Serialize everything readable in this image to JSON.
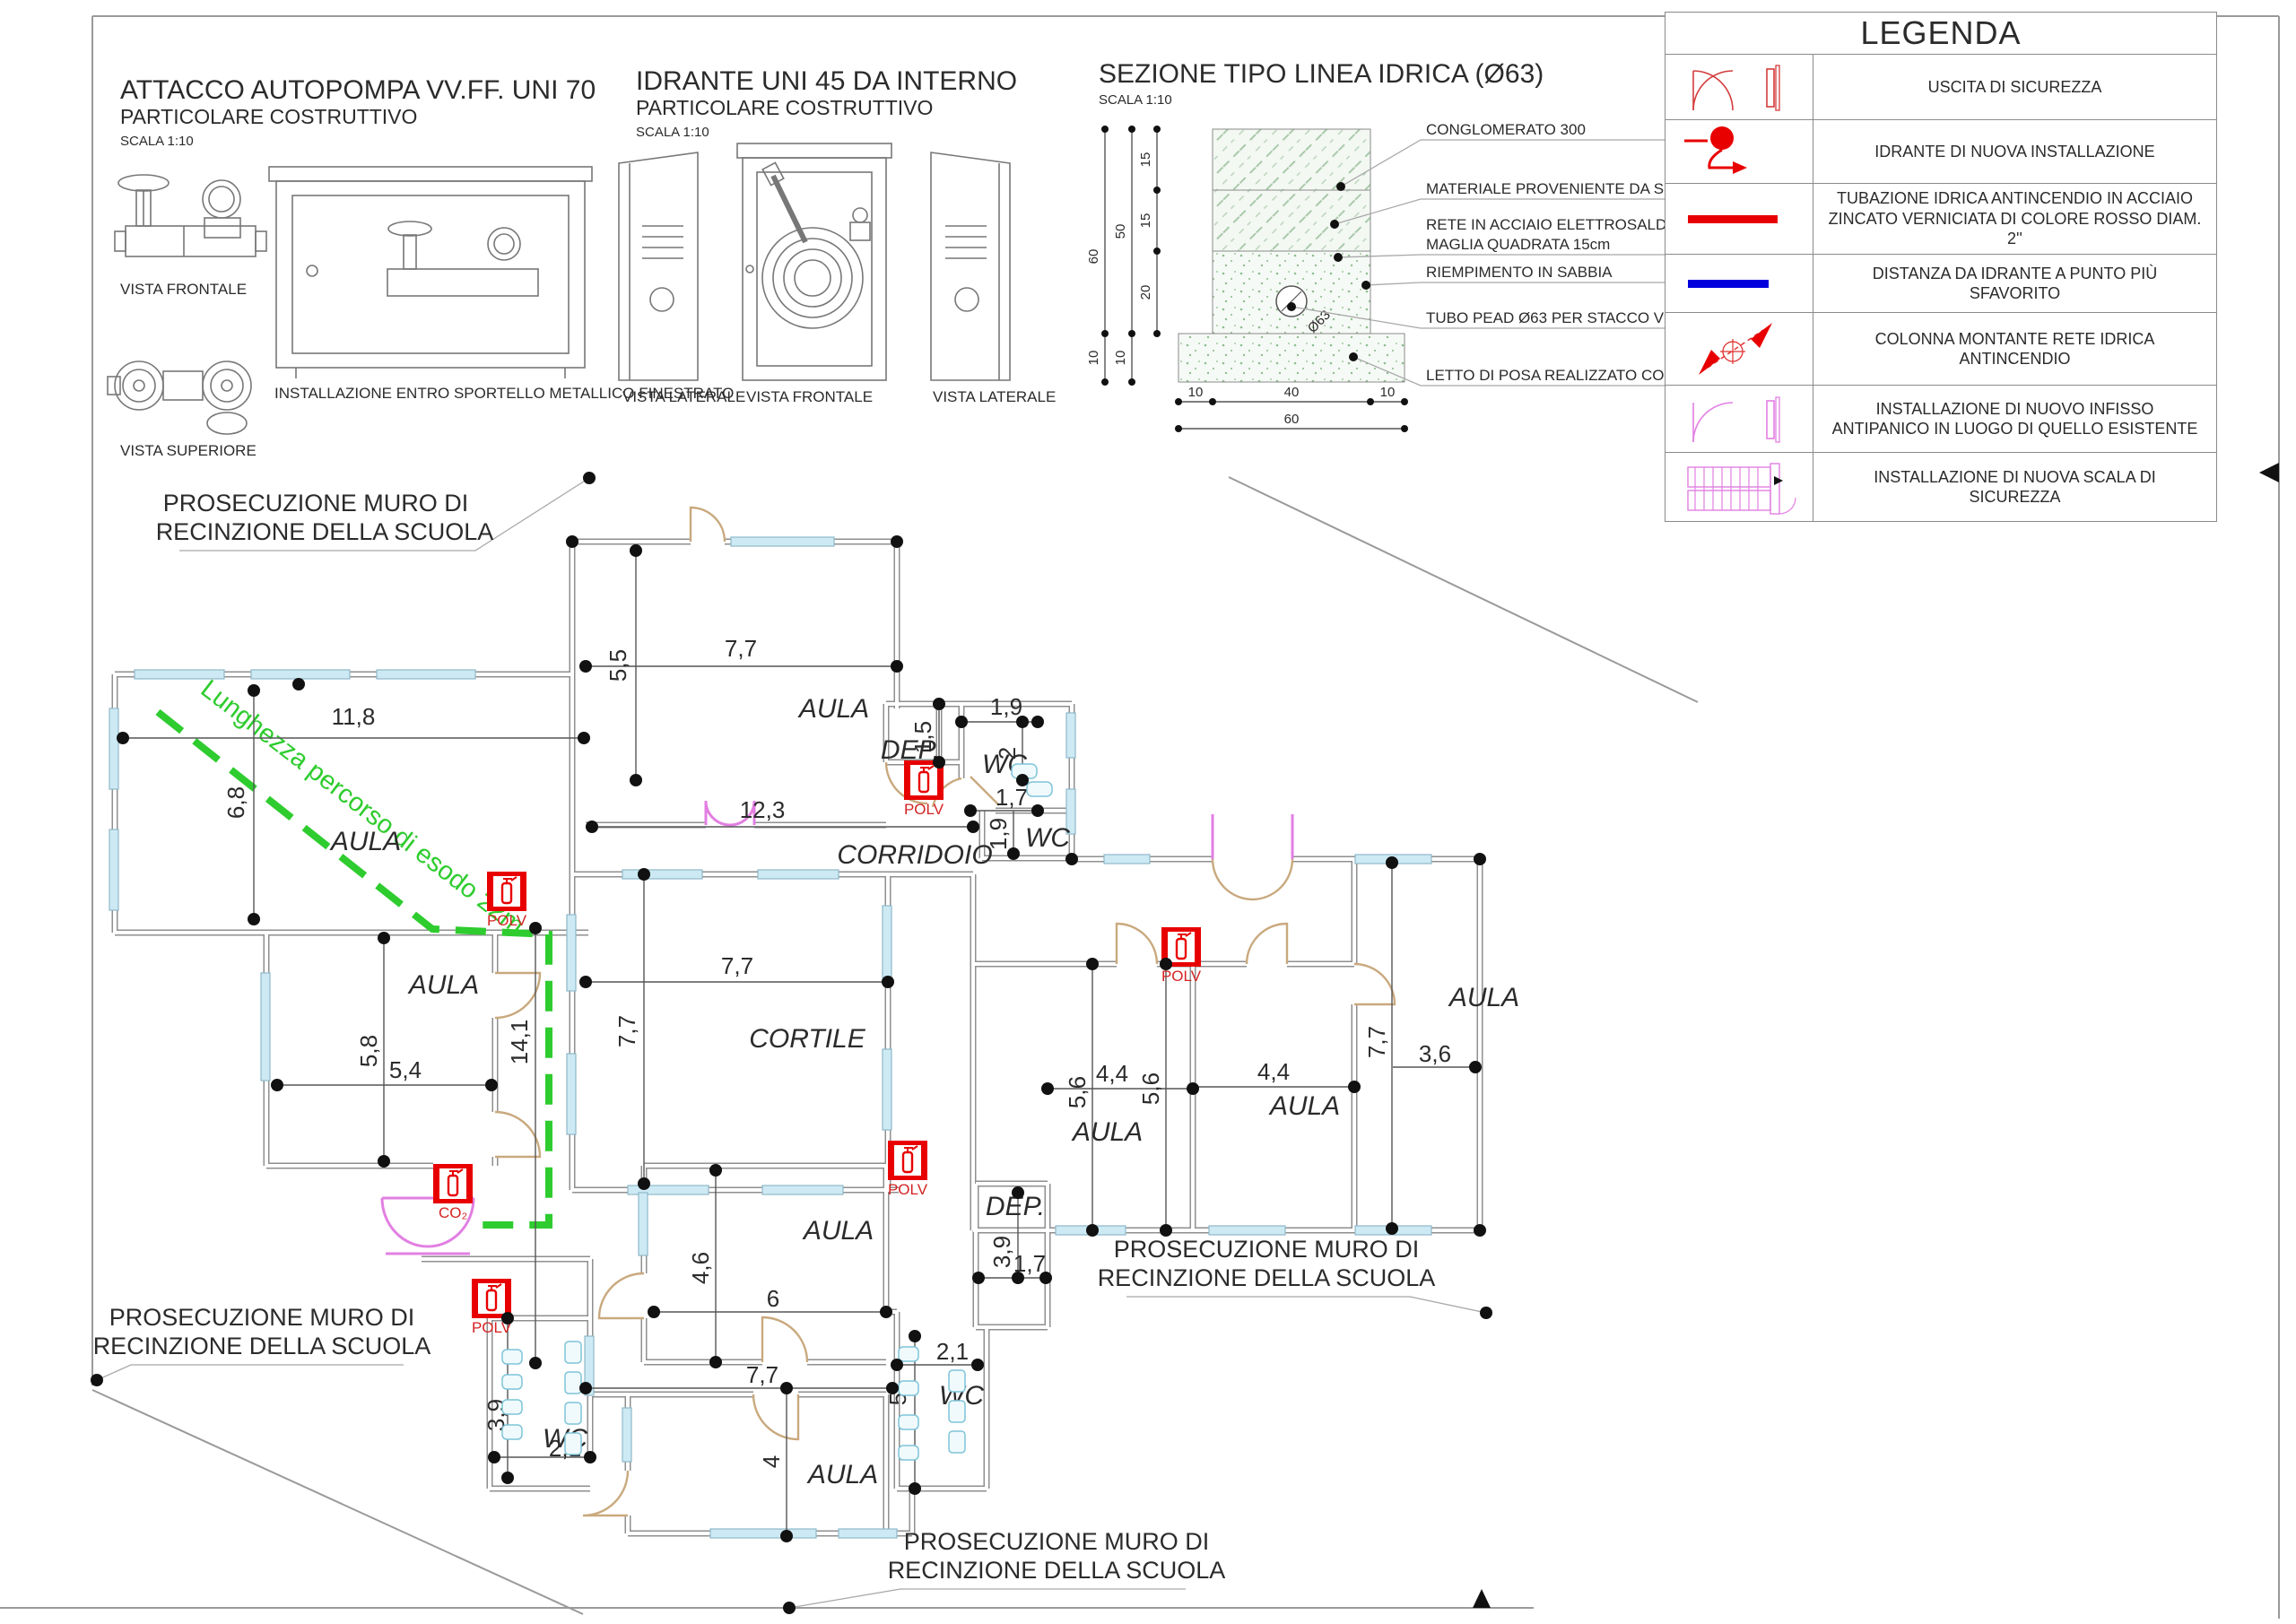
{
  "legend": {
    "title": "LEGENDA",
    "rows": [
      {
        "icon": "exit-door-icon",
        "label": "USCITA DI SICUREZZA"
      },
      {
        "icon": "hydrant-icon",
        "label": "IDRANTE DI NUOVA INSTALLAZIONE"
      },
      {
        "icon": "red-pipe-line-icon",
        "label": "TUBAZIONE IDRICA ANTINCENDIO IN ACCIAIO ZINCATO VERNICIATA DI COLORE ROSSO DIAM. 2''"
      },
      {
        "icon": "blue-distance-line-icon",
        "label": "DISTANZA DA IDRANTE A PUNTO PIÙ SFAVORITO"
      },
      {
        "icon": "riser-column-icon",
        "label": "COLONNA MONTANTE RETE IDRICA ANTINCENDIO"
      },
      {
        "icon": "panic-door-icon",
        "label": "INSTALLAZIONE DI NUOVO INFISSO ANTIPANICO IN LUOGO DI QUELLO ESISTENTE"
      },
      {
        "icon": "stairs-icon",
        "label": "INSTALLAZIONE DI NUOVA SCALA DI SICUREZZA"
      }
    ]
  },
  "details": {
    "attacco": {
      "title": "ATTACCO AUTOPOMPA VV.FF. UNI 70",
      "subtitle": "PARTICOLARE COSTRUTTIVO",
      "scale": "SCALA 1:10",
      "view_front": "VISTA FRONTALE",
      "view_top": "VISTA SUPERIORE",
      "cabinet_label": "INSTALLAZIONE ENTRO SPORTELLO METALLICO FINESTRATO"
    },
    "idrante": {
      "title": "IDRANTE UNI 45 DA INTERNO",
      "subtitle": "PARTICOLARE COSTRUTTIVO",
      "scale": "SCALA 1:10",
      "view_left1": "VISTA LATERALE",
      "view_front": "VISTA FRONTALE",
      "view_left2": "VISTA LATERALE"
    },
    "sezione": {
      "title": "SEZIONE TIPO LINEA IDRICA (Ø63)",
      "scale": "SCALA 1:10",
      "annotations": [
        "CONGLOMERATO 300",
        "MATERIALE PROVENIENTE DA SCAVO",
        "RETE IN ACCIAIO ELETTROSALDATA Ø8",
        "MAGLIA QUADRATA 15cm",
        "RIEMPIMENTO IN SABBIA",
        "TUBO PEAD Ø63 PER STACCO VERSO IDRANTE",
        "LETTO DI POSA REALIZZATO CON SABBIA"
      ],
      "pipe_label": "Ø63",
      "dims_vertical": [
        "60",
        "50",
        "15",
        "15",
        "20",
        "10",
        "10"
      ],
      "dims_horizontal": [
        "10",
        "40",
        "10",
        "60"
      ]
    }
  },
  "plan": {
    "room_labels": [
      "AULA",
      "AULA",
      "AULA",
      "CORRIDOIO",
      "DEP.",
      "WC",
      "WC",
      "CORTILE",
      "AULA",
      "AULA",
      "AULA",
      "AULA",
      "AULA",
      "WC",
      "DEP.",
      "WC"
    ],
    "dims": [
      "11,8",
      "6,8",
      "5,5",
      "7,7",
      "12,3",
      "1,9",
      "1,5",
      "2",
      "1,7",
      "1,9",
      "5,8",
      "5,4",
      "14,1",
      "7,7",
      "7,7",
      "4,4",
      "5,6",
      "4,4",
      "5,6",
      "7,7",
      "3,6",
      "4,6",
      "6",
      "7,7",
      "4",
      "2,1",
      "5",
      "3,9",
      "1,7",
      "3,9",
      "2,1"
    ],
    "fence_note_line1": "PROSECUZIONE MURO DI",
    "fence_note_line2": "RECINZIONE DELLA SCUOLA",
    "escape_note": "Lunghezza percorso di esodo 22m",
    "extinguishers": [
      "POLV",
      "POLV",
      "POLV",
      "POLV",
      "POLV",
      "CO₂"
    ]
  },
  "colors": {
    "fire_red": "#e80000",
    "distance_blue": "#0000dd",
    "escape_green": "#2ecc2e",
    "panic_magenta": "#e27fe2",
    "window_cyan": "#cdeaf4"
  }
}
